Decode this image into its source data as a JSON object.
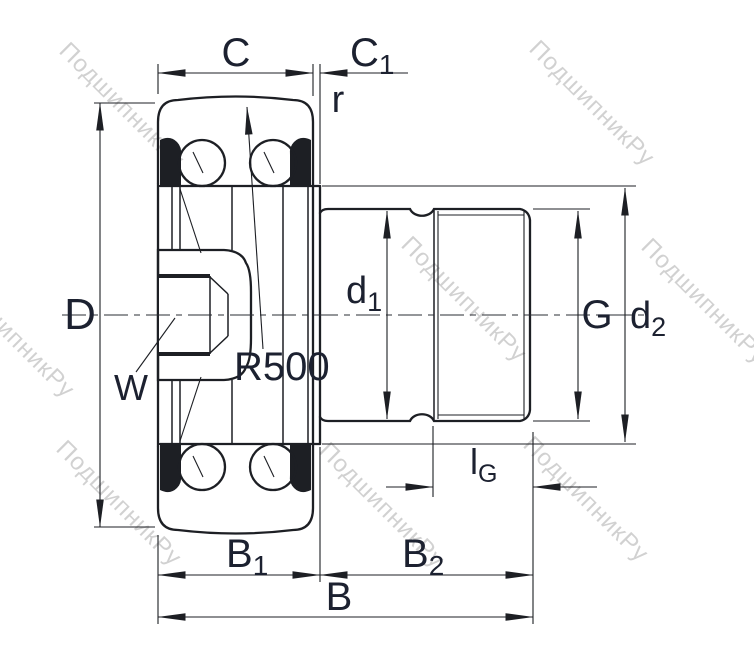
{
  "watermark": {
    "text": "ПодшипникРу"
  },
  "colors": {
    "line": "#1d1f24",
    "label": "#1c2130",
    "watermark": "#c8c8c8",
    "background": "#ffffff"
  },
  "labels": {
    "C": {
      "text": "C"
    },
    "C1": {
      "main": "C",
      "sub": "1"
    },
    "r": {
      "text": "r"
    },
    "D": {
      "text": "D"
    },
    "W": {
      "text": "W"
    },
    "R500": {
      "text": "R500"
    },
    "d1": {
      "main": "d",
      "sub": "1"
    },
    "G": {
      "text": "G"
    },
    "d2": {
      "main": "d",
      "sub": "2"
    },
    "lG": {
      "main": "l",
      "sub": "G"
    },
    "B1": {
      "main": "B",
      "sub": "1"
    },
    "B2": {
      "main": "B",
      "sub": "2"
    },
    "B": {
      "text": "B"
    }
  }
}
